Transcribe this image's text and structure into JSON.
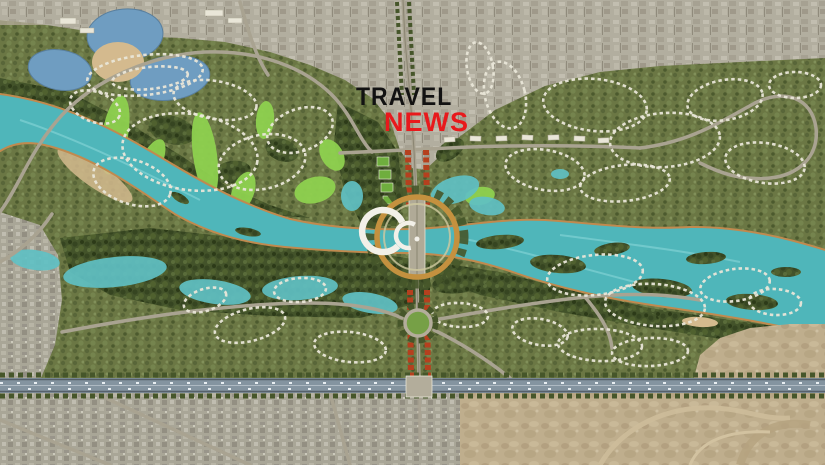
{
  "logo": {
    "line1": "TRAVEL",
    "line2": "NEWS",
    "line1_color": "#121212",
    "line2_color": "#e8191c"
  },
  "map": {
    "type": "aerial-masterplan-rendering",
    "features": [
      "turquoise-river-corridor",
      "golf-course-fairways",
      "residential-housing-clusters",
      "central-spiral-building",
      "ring-road-plaza",
      "tree-lined-boulevard",
      "green-roundabout",
      "bottom-highway",
      "northwest-reservoir-lakes",
      "wetland-lagoons",
      "existing-town-north",
      "existing-city-southwest",
      "desert-southeast"
    ]
  },
  "colors": {
    "base_terrain": "#a5a189",
    "vegetation": "#6b7744",
    "forest": "#43532a",
    "river": "#4fb6ba",
    "river_highlight": "#84d4d6",
    "riverbank": "#c08a4f",
    "lake": "#6f9dc1",
    "sand": "#d4ba8e",
    "golf": "#8ed14f",
    "wetland": "#5fc0c3",
    "road": "#a9a391",
    "road_dark": "#8a8572",
    "highway": "#8494a0",
    "highway_edge": "#56606a",
    "desert": "#bfae8d",
    "city": "#b2ae9f",
    "red_roofs": "#b5401e",
    "green_roofs": "#6fae3e",
    "white_houses": "#e9e6d8",
    "tree_line": "#46562a",
    "ring_road": "#c4913f",
    "roundabout_green": "#76a046",
    "building_white": "#f2f0e8",
    "logo_black": "#121212",
    "logo_red": "#e8191c"
  }
}
